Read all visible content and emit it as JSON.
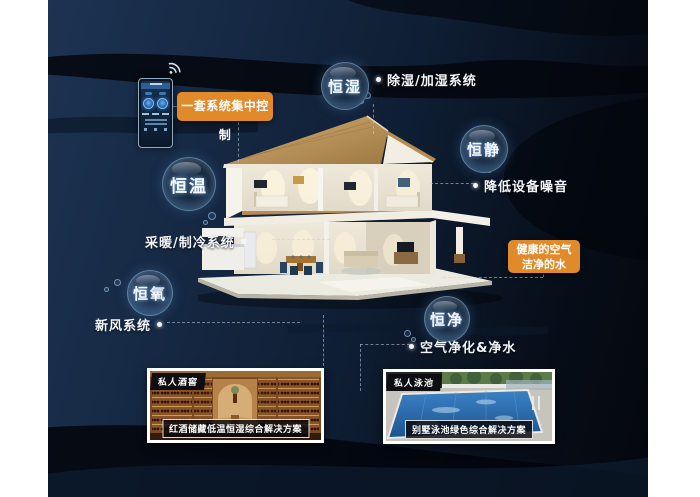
{
  "poster": {
    "device": {
      "name": "smart-home-control-panel",
      "wifi_icon": "wifi-icon"
    },
    "control_label": "一套系统集中控制",
    "bubbles": [
      {
        "label": "恒湿",
        "annotation": "除湿/加湿系统"
      },
      {
        "label": "恒静",
        "annotation": "降低设备噪音"
      },
      {
        "label": "恒温",
        "annotation": "采暖/制冷系统"
      },
      {
        "label": "恒氧",
        "annotation": "新风系统"
      },
      {
        "label": "恒净",
        "annotation": "空气净化&净水"
      }
    ],
    "highlight_box": {
      "line1": "健康的空气",
      "line2": "洁净的水"
    },
    "cards": [
      {
        "tag": "私人酒窖",
        "caption": "红酒储藏低温恒湿综合解决方案"
      },
      {
        "tag": "私人泳池",
        "caption": "别墅泳池绿色综合解决方案"
      }
    ],
    "colors": {
      "accent_orange": "#E18A2B",
      "background_navy": "#14273F",
      "wave_black": "#04070D",
      "label_text": "#F2F6FA",
      "bubble_rim": "#96C8F0"
    }
  }
}
